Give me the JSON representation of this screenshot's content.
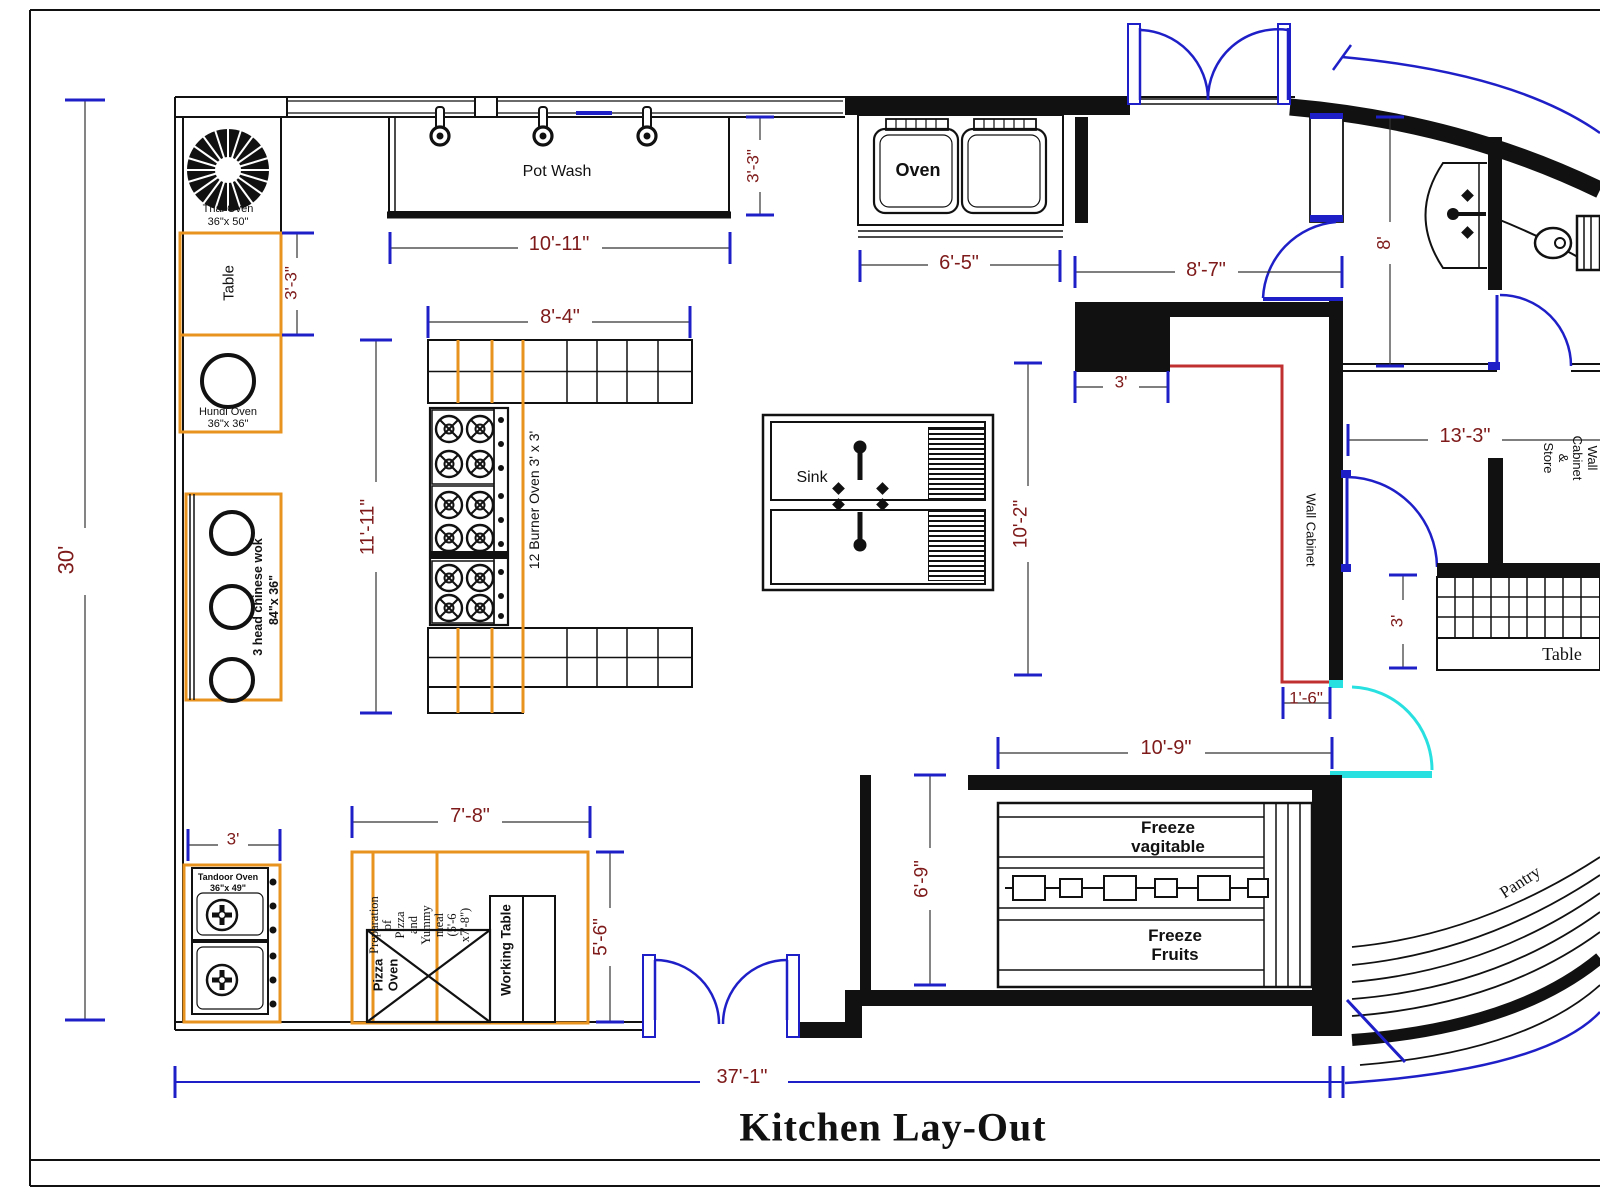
{
  "title": "Kitchen Lay-Out",
  "colors": {
    "wall": "#111111",
    "dim_text": "#7E1A1A",
    "dim_tick_blue": "#1F1FC8",
    "door_blue": "#1F1FC8",
    "door_cyan": "#29E0E0",
    "equipment_orange": "#E8931F",
    "cabinet_red_line": "#C03030"
  },
  "fixtures": {
    "thai_oven": {
      "name": "Thai Oven",
      "size": "36\"x 50\""
    },
    "table_left": "Table",
    "hundi_oven": {
      "name": "Hundi Oven",
      "size": "36\"x 36\""
    },
    "chinese_wok": {
      "name": "3 head chinese wok",
      "size": "84\"x 36\""
    },
    "pot_wash": "Pot Wash",
    "oven": "Oven",
    "burner_oven": "12 Burner Oven 3' x 3'",
    "sink": "Sink",
    "wall_cabinet": "Wall Cabinet",
    "wall_cabinet_store": "Wall Cabinet &\nStore",
    "table_right": "Table",
    "freeze_vegetable": "Freeze\nvagitable",
    "freeze_fruits": "Freeze\nFruits",
    "pantry": "Pantry",
    "tandoor_oven": {
      "name": "Tandoor Oven",
      "size": "36\"x 49\""
    },
    "prep_area": "Preparation\nof\nPizza\nand\nYummy\nmeal\n(5'-6\nx7'-8\")",
    "pizza_oven": "Pizza\nOven",
    "working_table": "Working Table"
  },
  "dims": {
    "overall_height": "30'",
    "overall_width": "37'-1\"",
    "table_left_h": "3'-3\"",
    "pot_wash_w": "10'-11\"",
    "pot_wash_h": "3'-3\"",
    "oven_w": "6'-5\"",
    "corridor_w": "8'-7\"",
    "bathroom_h": "8'",
    "store_w": "13'-3\"",
    "table_right_w": "3'",
    "cabinet_block_w": "3'",
    "island_w": "8'-4\"",
    "island_h": "11'-11\"",
    "sink_row_h": "10'-2\"",
    "cabinet_gap": "1'-6\"",
    "freeze_w": "10'-9\"",
    "freeze_h": "6'-9\"",
    "tandoor_w": "3'",
    "prep_w": "7'-8\"",
    "prep_h": "5'-6\""
  }
}
